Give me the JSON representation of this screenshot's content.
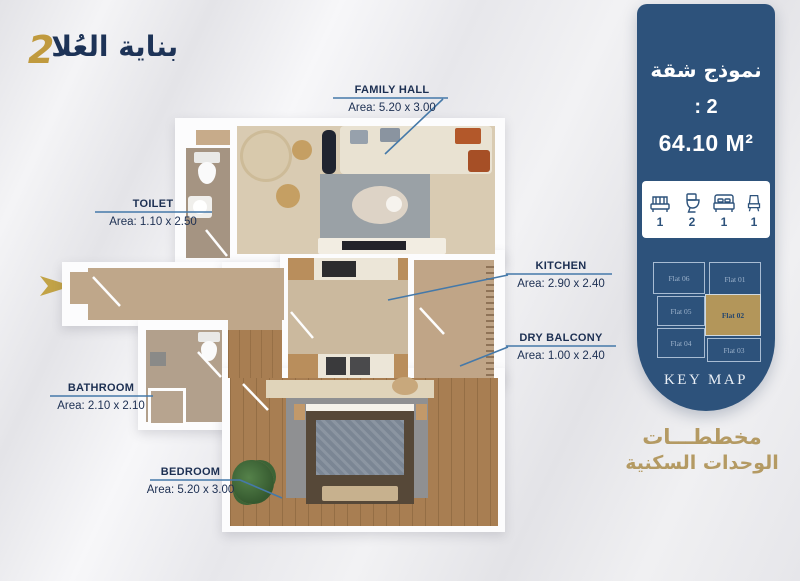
{
  "colors": {
    "panel_blue": "#2d527b",
    "gold_accent": "#b3965a",
    "label_navy": "#1c2f52",
    "leader_blue": "#4579a9"
  },
  "logo": {
    "title_ar": "بناية العُلا",
    "number": "2"
  },
  "entrance": {
    "arrow": "right-arrow"
  },
  "panel": {
    "model_label_ar": "نموذج شقة",
    "model_number": ": 2",
    "area_value": "64.10 M²",
    "stats": [
      {
        "icon": "sofa-icon",
        "count": "1"
      },
      {
        "icon": "toilet-icon",
        "count": "2"
      },
      {
        "icon": "bed-icon",
        "count": "1"
      },
      {
        "icon": "chair-icon",
        "count": "1"
      }
    ],
    "keymap": {
      "title": "KEY MAP",
      "flats": [
        {
          "name": "Flat 06",
          "highlighted": false
        },
        {
          "name": "Flat 01",
          "highlighted": false
        },
        {
          "name": "Flat 05",
          "highlighted": false
        },
        {
          "name": "Flat 02",
          "highlighted": true
        },
        {
          "name": "Flat 04",
          "highlighted": false
        },
        {
          "name": "Flat 03",
          "highlighted": false
        }
      ]
    }
  },
  "footer": {
    "line1_ar": "مخططـــات",
    "line2_ar": "الوحدات السكنية"
  },
  "plan": {
    "labels": [
      {
        "name": "FAMILY HALL",
        "area": "Area: 5.20 x 3.00"
      },
      {
        "name": "TOILET",
        "area": "Area: 1.10 x 2.50"
      },
      {
        "name": "KITCHEN",
        "area": "Area: 2.90 x 2.40"
      },
      {
        "name": "DRY BALCONY",
        "area": "Area: 1.00 x 2.40"
      },
      {
        "name": "BATHROOM",
        "area": "Area: 2.10 x 2.10"
      },
      {
        "name": "BEDROOM",
        "area": "Area: 5.20 x 3.00"
      }
    ]
  }
}
